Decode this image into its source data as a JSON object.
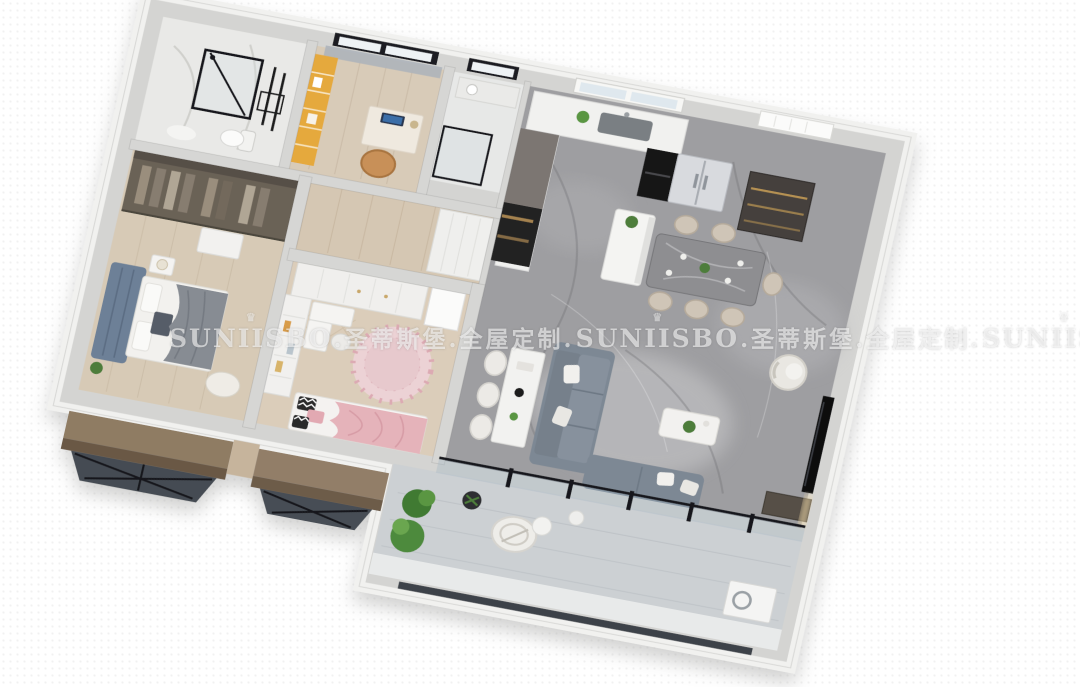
{
  "watermark": {
    "crown_glyph": "♛",
    "segments": [
      {
        "kind": "brand",
        "text": "SUNIISBO"
      },
      {
        "kind": "cn",
        "text": ".圣蒂斯堡.全屋定制."
      },
      {
        "kind": "brand",
        "text": "SUNIISBO"
      },
      {
        "kind": "cn",
        "text": ".圣蒂斯堡.全屋定制."
      },
      {
        "kind": "brand",
        "text": "SUNIISBO"
      }
    ]
  },
  "palette": {
    "background": "#ffffff",
    "outer_wall": "#d4d4d2",
    "wall_rim": "#f1f1ef",
    "marble_floor": "#9e9ea1",
    "marble_vein_light": "#c9c9cb",
    "marble_vein_dark": "#6f6f73",
    "wood_floor": "#d6c9b6",
    "bath_tile": "#e9e9e7",
    "sofa_gray": "#7d8894",
    "headboard_blue": "#6d8097",
    "pink_blanket": "#e5b3ba",
    "pink_rug": "#ecd2d5",
    "accent_orange": "#e5a93e",
    "chair_tan": "#c89058",
    "dining_chair_beige": "#cfc5b7",
    "plant_green": "#4e7d3a",
    "cove_light": "#f3dca4",
    "window_bronze": "#8f7b64",
    "glass_dark": "#454b52",
    "frame_black": "#17181a",
    "appliance_silver": "#d8dade",
    "watermark_color": "rgba(255,255,255,0.58)"
  }
}
